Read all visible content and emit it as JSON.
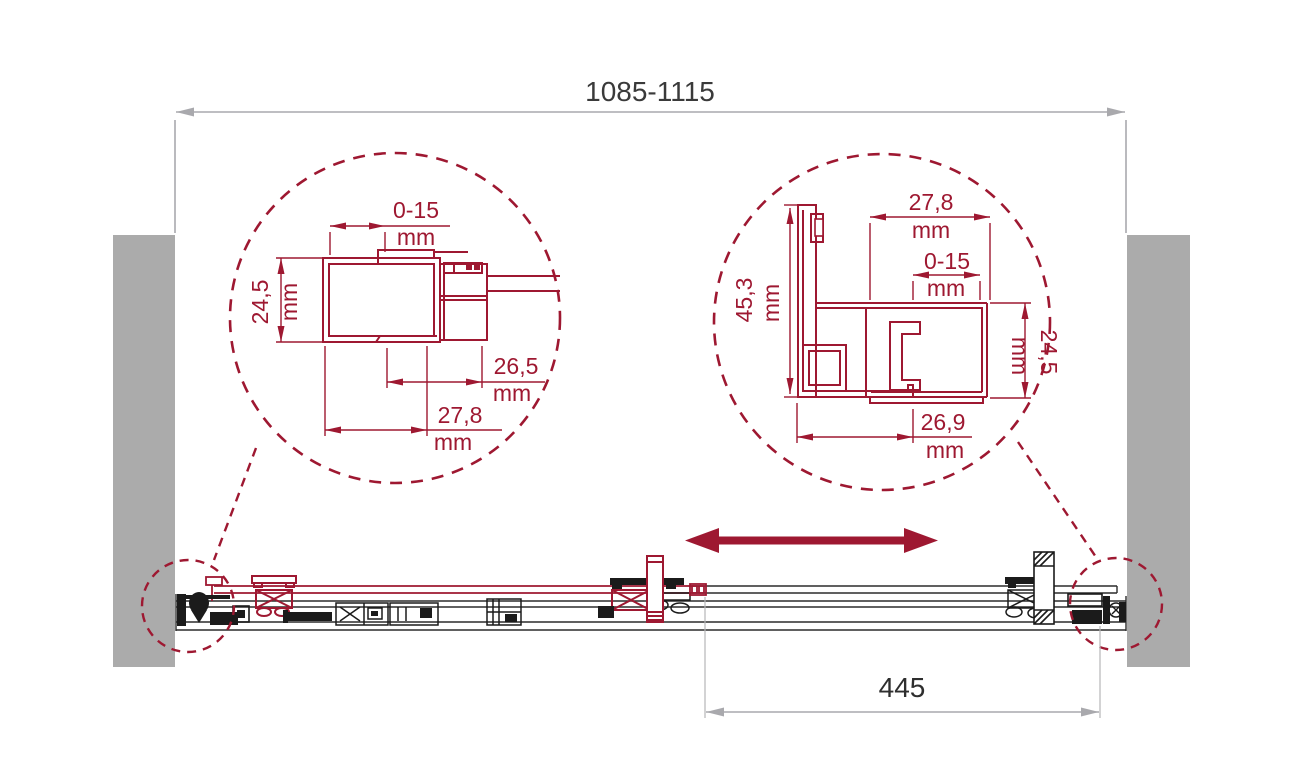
{
  "labels": {
    "overall_width": "1085-1115",
    "travel": "445",
    "unit": "mm",
    "left_detail": {
      "adjust": "0-15",
      "depth": "24,5",
      "inner_width": "26,5",
      "outer_width": "27,8"
    },
    "right_detail": {
      "top_width": "27,8",
      "adjust": "0-15",
      "wall_height": "45,3",
      "door_depth": "24,5",
      "bottom_width": "26,9"
    }
  },
  "colors": {
    "profile_red": "#9e1831",
    "wall_gray": "#ababab",
    "dimension_gray": "#a9a9ad",
    "text_dark": "#3a3a3a",
    "hardware_black": "#1b1b1b"
  },
  "icons": {
    "slide_direction": "double-arrow-icon"
  }
}
